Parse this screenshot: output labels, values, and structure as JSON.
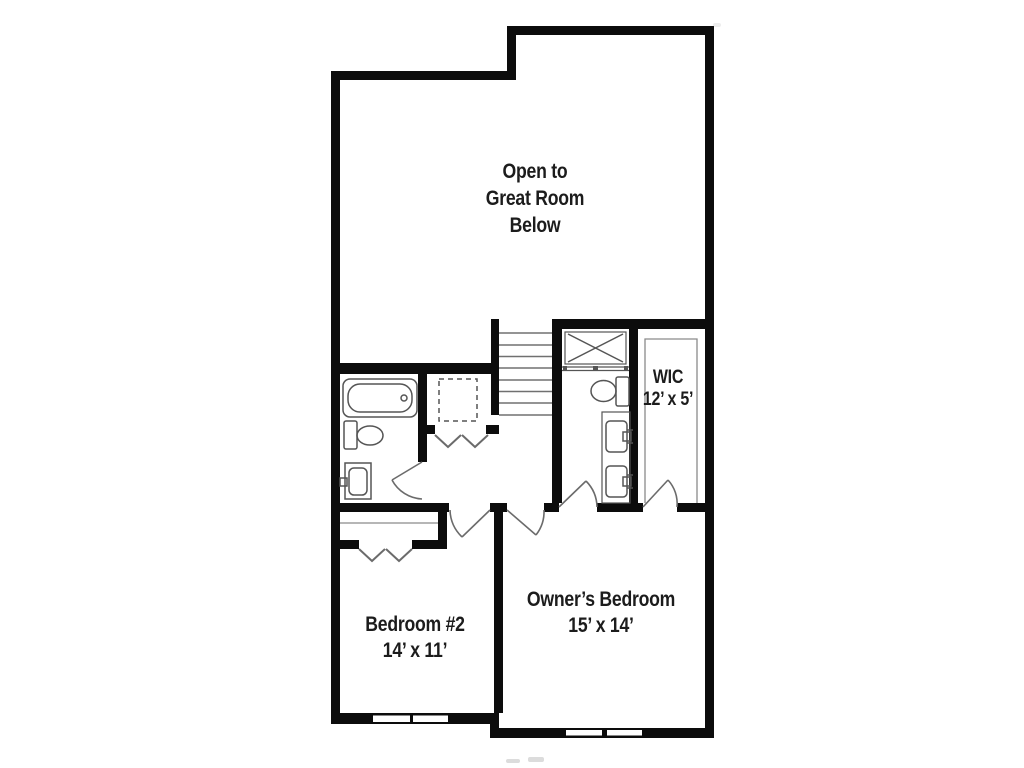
{
  "floor_plan": {
    "title": "Second floor plan",
    "rooms": {
      "great_room": {
        "label_line1": "Open to",
        "label_line2": "Great Room",
        "label_line3": "Below"
      },
      "wic": {
        "name": "WIC",
        "dimensions": "12’ x 5’"
      },
      "bedroom2": {
        "name": "Bedroom #2",
        "dimensions": "14’ x 11’"
      },
      "owners_bedroom": {
        "name": "Owner’s Bedroom",
        "dimensions": "15’ x 14’"
      }
    },
    "fixtures": [
      "bathtub",
      "toilet",
      "sink-vanity",
      "linen-dashed-box",
      "stairs",
      "shower",
      "toilet",
      "double-sink-vanity",
      "closet-shelves",
      "bifold-closet-doors",
      "swing-doors",
      "windows"
    ],
    "colors": {
      "wall": "#0c0c0c",
      "fixture": "#555555",
      "door": "#6b6b6b",
      "text": "#1c1c1c",
      "background": "#ffffff"
    }
  }
}
